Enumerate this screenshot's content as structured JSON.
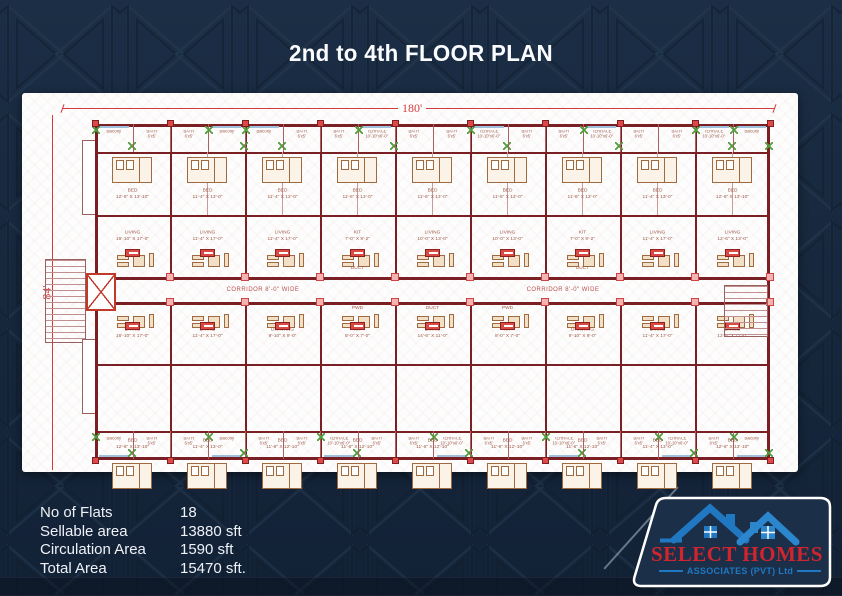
{
  "title": "2nd to 4th FLOOR PLAN",
  "stats": {
    "rows": [
      {
        "label": "No of Flats",
        "value": "18"
      },
      {
        "label": "Sellable area",
        "value": "13880 sft"
      },
      {
        "label": "Circulation Area",
        "value": "1590 sft"
      },
      {
        "label": "Total Area",
        "value": "15470  sft."
      }
    ]
  },
  "logo": {
    "name": "SELECT HOMES",
    "subtitle": "ASSOCIATES (PVT) Ltd",
    "colors": {
      "name_red": "#d0252e",
      "blue": "#1f78c1",
      "roof_blue2": "#2b86cd"
    }
  },
  "plan": {
    "width_dim": "180'",
    "height_dim": "84'",
    "corridor_labels": [
      "CORRIDOR 8'-0\" WIDE",
      "CORRIDOR 8'-0\" WIDE"
    ],
    "top_strip": [
      {
        "label": "Balcony",
        "dim": ""
      },
      {
        "label": "BATH",
        "dim": "6'x5'"
      },
      {
        "label": "BATH",
        "dim": "6'x5'"
      },
      {
        "label": "Balcony",
        "dim": ""
      },
      {
        "label": "Balcony",
        "dim": ""
      },
      {
        "label": "BATH",
        "dim": "6'x5'"
      },
      {
        "label": "BATH",
        "dim": "6'x5'"
      },
      {
        "label": "TERRACE",
        "dim": "10'-10\"x6'-0\""
      },
      {
        "label": "BATH",
        "dim": "6'x5'"
      },
      {
        "label": "BATH",
        "dim": "6'x5'"
      },
      {
        "label": "TERRACE",
        "dim": "10'-10\"x6'-0\""
      },
      {
        "label": "BATH",
        "dim": "6'x5'"
      },
      {
        "label": "BATH",
        "dim": "6'x5'"
      },
      {
        "label": "TERRACE",
        "dim": "10'-10\"x6'-0\""
      },
      {
        "label": "BATH",
        "dim": "6'x5'"
      },
      {
        "label": "BATH",
        "dim": "6'x5'"
      },
      {
        "label": "TERRACE",
        "dim": "10'-10\"x6'-0\""
      },
      {
        "label": "Balcony",
        "dim": ""
      }
    ],
    "bottom_strip": [
      {
        "label": "Balcony",
        "dim": ""
      },
      {
        "label": "BATH",
        "dim": "6'x5'"
      },
      {
        "label": "BATH",
        "dim": "6'x5'"
      },
      {
        "label": "Balcony",
        "dim": ""
      },
      {
        "label": "BATH",
        "dim": "6'x5'"
      },
      {
        "label": "BATH",
        "dim": "6'x5'"
      },
      {
        "label": "TERRACE",
        "dim": "10'-10\"x6'-0\""
      },
      {
        "label": "BATH",
        "dim": "6'x5'"
      },
      {
        "label": "BATH",
        "dim": "6'x5'"
      },
      {
        "label": "TERRACE",
        "dim": "10'-10\"x6'-0\""
      },
      {
        "label": "BATH",
        "dim": "6'x5'"
      },
      {
        "label": "BATH",
        "dim": "6'x5'"
      },
      {
        "label": "TERRACE",
        "dim": "10'-10\"x6'-0\""
      },
      {
        "label": "BATH",
        "dim": "6'x5'"
      },
      {
        "label": "BATH",
        "dim": "6'x5'"
      },
      {
        "label": "TERRACE",
        "dim": "10'-10\"x6'-0\""
      },
      {
        "label": "BATH",
        "dim": "6'x5'"
      },
      {
        "label": "Balcony",
        "dim": ""
      }
    ],
    "top_units": [
      {
        "bed": "BED",
        "bed_dim": "12'-6\" X 13'-10\"",
        "living": "LIVING",
        "living_dim": "16'-10\" X 17'-0\"",
        "extra": ""
      },
      {
        "bed": "BED",
        "bed_dim": "11'-4\" X 13'-0\"",
        "living": "LIVING",
        "living_dim": "11'-4\" X 17'-0\"",
        "extra": ""
      },
      {
        "bed": "BED",
        "bed_dim": "11'-4\" X 13'-0\"",
        "living": "LIVING",
        "living_dim": "11'-4\" X 17'-0\"",
        "extra": ""
      },
      {
        "bed": "BED",
        "bed_dim": "11'-6\" X 13'-0\"",
        "living": "KIT",
        "living_dim": "7'-0\" X 9'-2\"",
        "extra": "DUCT"
      },
      {
        "bed": "BED",
        "bed_dim": "11'-6\" X 13'-0\"",
        "living": "LIVING",
        "living_dim": "10'-0\" X 13'-0\"",
        "extra": ""
      },
      {
        "bed": "BED",
        "bed_dim": "11'-6\" X 13'-0\"",
        "living": "LIVING",
        "living_dim": "10'-0\" X 13'-0\"",
        "extra": ""
      },
      {
        "bed": "BED",
        "bed_dim": "11'-6\" X 13'-0\"",
        "living": "KIT",
        "living_dim": "7'-0\" X 9'-2\"",
        "extra": "DUCT"
      },
      {
        "bed": "BED",
        "bed_dim": "11'-4\" X 13'-0\"",
        "living": "LIVING",
        "living_dim": "11'-4\" X 17'-0\"",
        "extra": ""
      },
      {
        "bed": "BED",
        "bed_dim": "12'-6\" X 13'-10\"",
        "living": "LIVING",
        "living_dim": "12'-6\" X 13'-0\"",
        "extra": ""
      }
    ],
    "bottom_units": [
      {
        "bed": "BED",
        "bed_dim": "12'-6\" X 13'-10\"",
        "living": "LIVING",
        "living_dim": "16'-10\" X 17'-0\"",
        "extra": ""
      },
      {
        "bed": "BED",
        "bed_dim": "11'-4\" X 13'-0\"",
        "living": "LIVING",
        "living_dim": "11'-4\" X 17'-0\"",
        "extra": ""
      },
      {
        "bed": "BED",
        "bed_dim": "11'-6\" X 12'-10\"",
        "living": "DRAWING",
        "living_dim": "9'-10\" X 9'-0\"",
        "extra": ""
      },
      {
        "bed": "BED",
        "bed_dim": "11'-6\" X 12'-10\"",
        "living": "KIT",
        "living_dim": "8'-0\" X 7'-0\"",
        "extra": "PWD"
      },
      {
        "bed": "BED",
        "bed_dim": "11'-6\" X 12'-10\"",
        "living": "LIVING",
        "living_dim": "14'-6\" X 11'-0\"",
        "extra": "DUCT"
      },
      {
        "bed": "BED",
        "bed_dim": "11'-6\" X 12'-10\"",
        "living": "KIT",
        "living_dim": "8'-0\" X 7'-0\"",
        "extra": "PWD"
      },
      {
        "bed": "BED",
        "bed_dim": "11'-6\" X 12'-10\"",
        "living": "DRAWING",
        "living_dim": "9'-10\" X 9'-0\"",
        "extra": ""
      },
      {
        "bed": "BED",
        "bed_dim": "11'-4\" X 13'-0\"",
        "living": "LIVING",
        "living_dim": "11'-4\" X 17'-0\"",
        "extra": ""
      },
      {
        "bed": "BED",
        "bed_dim": "12'-6\" X 13'-10\"",
        "living": "LIVING",
        "living_dim": "12'-6\" X 17'-0\"",
        "extra": ""
      }
    ],
    "colors": {
      "wall": "#7a2024",
      "wall_light": "#a86060",
      "dim_red": "#d23c3c",
      "accent_red": "#e04848",
      "junction_pink": "#f3b3b3",
      "plant_green": "#4f9e3b",
      "background_navy": "#16273c",
      "panel_white": "#fdfdfd"
    }
  }
}
